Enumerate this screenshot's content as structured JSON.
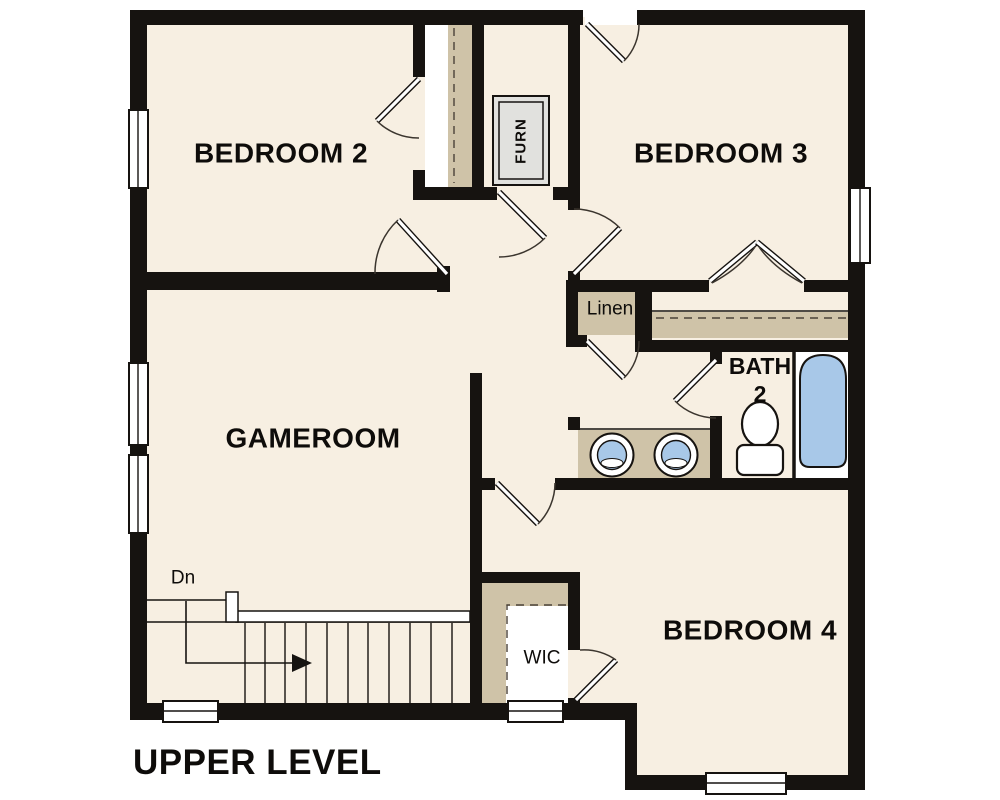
{
  "title": "UPPER LEVEL",
  "colors": {
    "wall": "#161310",
    "floor": "#f7efe2",
    "tan": "#cfc3a8",
    "blue": "#a8c8e8",
    "furn_gray": "#e1e1de"
  },
  "rooms": {
    "bedroom2": {
      "label": "BEDROOM 2"
    },
    "bedroom3": {
      "label": "BEDROOM 3"
    },
    "gameroom": {
      "label": "GAMEROOM"
    },
    "bedroom4": {
      "label": "BEDROOM 4"
    },
    "bath2": {
      "line1": "BATH",
      "line2": "2"
    },
    "linen": {
      "label": "Linen"
    },
    "wic": {
      "label": "WIC"
    },
    "furnace": {
      "label": "FURN"
    }
  },
  "stairs": {
    "down_label": "Dn"
  }
}
